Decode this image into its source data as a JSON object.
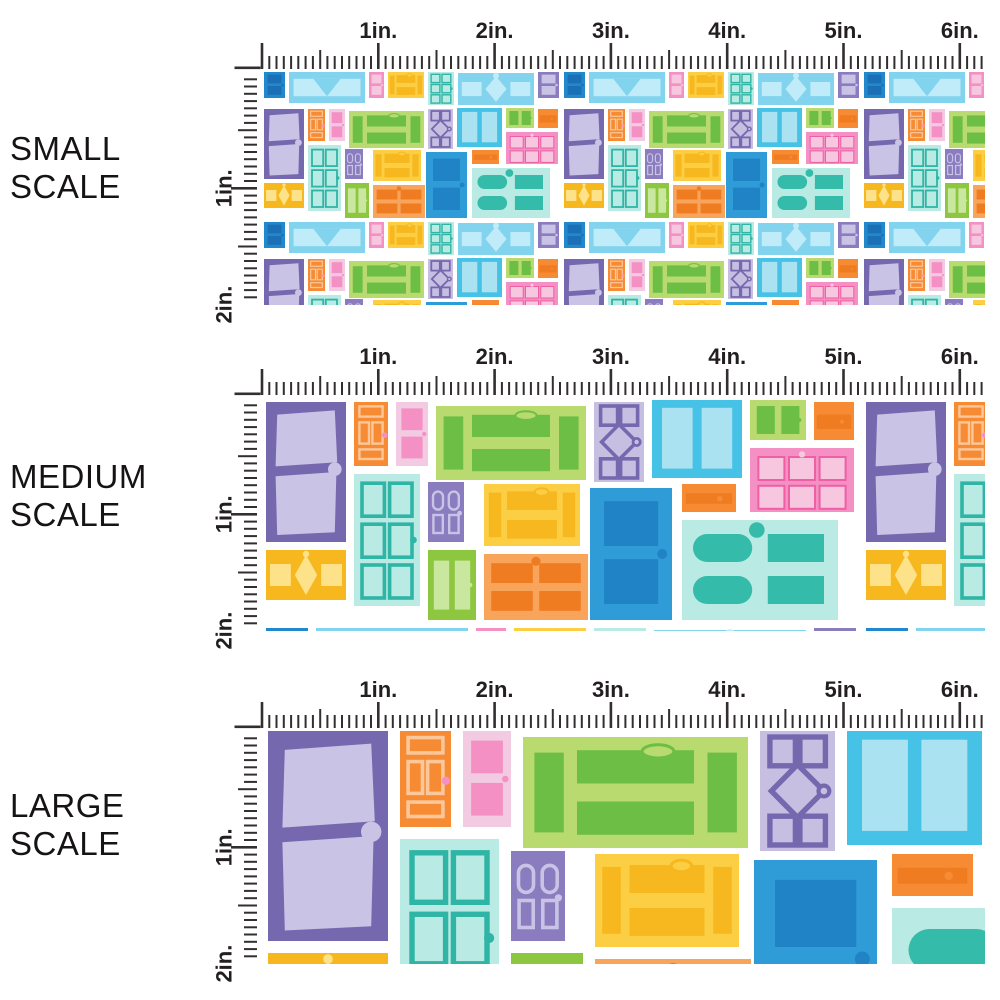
{
  "image_title": "Doors fabric scale comparison",
  "sections": [
    {
      "id": "small",
      "label_lines": [
        "SMALL",
        "SCALE"
      ],
      "scale": 1,
      "pattern_offset_y": 115
    },
    {
      "id": "medium",
      "label_lines": [
        "MEDIUM",
        "SCALE"
      ],
      "scale": 2,
      "pattern_offset_y": 0
    },
    {
      "id": "large",
      "label_lines": [
        "LARGE",
        "SCALE"
      ],
      "scale": 3,
      "pattern_offset_y": 2
    }
  ],
  "ruler": {
    "top_labels": [
      "1in.",
      "2in.",
      "3in.",
      "4in.",
      "5in.",
      "6in."
    ],
    "side_labels": [
      "1in.",
      "2in."
    ],
    "tick_color": "#332f31",
    "label_color": "#231f20",
    "minor_per_inch": 16
  },
  "palette": {
    "purple": "#7668AE",
    "purpleMid": "#8A7CBE",
    "lavender": "#C9C3E6",
    "lavenderLt": "#C6BFE2",
    "orange": "#F68B33",
    "orangePale": "#FBC79B",
    "orangeLight": "#F9A45B",
    "orangeDark": "#F07C22",
    "pinkMid": "#F590C4",
    "pinkLight": "#F6C7DF",
    "pinkPale": "#F2CBE3",
    "pinkDark": "#EE5FA4",
    "yellowGreen": "#B8DA6E",
    "greenDark": "#6CBE45",
    "grass": "#8DC63F",
    "greenPale": "#C9E79E",
    "yellowDark": "#F6B81E",
    "yellowMid": "#FBCE44",
    "yellowLight": "#FDE289",
    "mint": "#B9EAE3",
    "teal": "#2EB5A5",
    "tealFill": "#35BBA9",
    "cyan": "#45C2E5",
    "cyanLight": "#ABE2F2",
    "skyblue": "#82D4EE",
    "skyblueLight": "#C0EBF8",
    "blue": "#2F9CD8",
    "blueDark": "#1F83C5",
    "blueSq": "#2288CE",
    "blueSqDark": "#1A6FB5"
  },
  "tile": {
    "width": 300,
    "height": 150,
    "doors": [
      {
        "style": "trap2",
        "x": 2,
        "y": 2,
        "w": 40,
        "h": 70,
        "body": "purple",
        "panel": "lavender"
      },
      {
        "style": "outline3",
        "x": 46,
        "y": 2,
        "w": 17,
        "h": 32,
        "body": "orange",
        "panel": "orangePale"
      },
      {
        "style": "rect2",
        "x": 67,
        "y": 2,
        "w": 16,
        "h": 32,
        "body": "pinkPale",
        "panel": "pinkMid"
      },
      {
        "style": "bars",
        "x": 87,
        "y": 4,
        "w": 75,
        "h": 37,
        "body": "yellowGreen",
        "panel": "greenDark"
      },
      {
        "style": "diamond",
        "x": 166,
        "y": 2,
        "w": 25,
        "h": 40,
        "body": "lavenderLt",
        "panel": "purple"
      },
      {
        "style": "tall2",
        "x": 195,
        "y": 1,
        "w": 45,
        "h": 39,
        "body": "cyan",
        "panel": "cyanLight"
      },
      {
        "style": "green2",
        "x": 244,
        "y": 1,
        "w": 28,
        "h": 20,
        "body": "yellowGreen",
        "panel": "greenDark"
      },
      {
        "style": "grid6f",
        "x": 244,
        "y": 25,
        "w": 52,
        "h": 32,
        "body": "pinkMid",
        "panel": "pinkLight",
        "stroke": "pinkDark"
      },
      {
        "style": "bar1",
        "x": 276,
        "y": 2,
        "w": 20,
        "h": 19,
        "body": "orange",
        "panel": "orangeDark"
      },
      {
        "style": "diamondwide",
        "x": 2,
        "y": 76,
        "w": 40,
        "h": 25,
        "body": "yellowDark",
        "panel": "yellowLight"
      },
      {
        "style": "grid6s",
        "x": 46,
        "y": 38,
        "w": 33,
        "h": 66,
        "body": "mint",
        "panel": "teal"
      },
      {
        "style": "arch4",
        "x": 83,
        "y": 42,
        "w": 18,
        "h": 30,
        "body": "purpleMid",
        "panel": "lavender"
      },
      {
        "style": "green2",
        "x": 83,
        "y": 76,
        "w": 24,
        "h": 35,
        "body": "grass",
        "panel": "greenPale"
      },
      {
        "style": "bars",
        "x": 111,
        "y": 43,
        "w": 48,
        "h": 31,
        "body": "yellowMid",
        "panel": "yellowDark"
      },
      {
        "style": "panel4",
        "x": 111,
        "y": 78,
        "w": 52,
        "h": 33,
        "body": "orangeLight",
        "panel": "orangeDark"
      },
      {
        "style": "rect2",
        "x": 164,
        "y": 45,
        "w": 41,
        "h": 66,
        "body": "blue",
        "panel": "blueDark"
      },
      {
        "style": "bar1",
        "x": 210,
        "y": 43,
        "w": 27,
        "h": 14,
        "body": "orange",
        "panel": "orangeDark"
      },
      {
        "style": "archwide",
        "x": 210,
        "y": 61,
        "w": 78,
        "h": 50,
        "body": "mint",
        "panel": "tealFill"
      },
      {
        "style": "rect2",
        "x": 2,
        "y": 115,
        "w": 21,
        "h": 26,
        "body": "blueSq",
        "panel": "blueSqDark"
      },
      {
        "style": "vee",
        "x": 27,
        "y": 115,
        "w": 76,
        "h": 31,
        "body": "skyblue",
        "panel": "skyblueLight"
      },
      {
        "style": "rect2",
        "x": 107,
        "y": 115,
        "w": 15,
        "h": 26,
        "body": "pinkMid",
        "panel": "pinkLight"
      },
      {
        "style": "bars",
        "x": 126,
        "y": 115,
        "w": 36,
        "h": 26,
        "body": "yellowMid",
        "panel": "yellowDark"
      },
      {
        "style": "grid6s",
        "x": 166,
        "y": 115,
        "w": 26,
        "h": 33,
        "body": "mint",
        "panel": "teal"
      },
      {
        "style": "diamondwide",
        "x": 196,
        "y": 116,
        "w": 76,
        "h": 32,
        "body": "skyblue",
        "panel": "skyblueLight"
      },
      {
        "style": "rect2",
        "x": 276,
        "y": 115,
        "w": 21,
        "h": 26,
        "body": "purpleMid",
        "panel": "lavender"
      }
    ]
  }
}
